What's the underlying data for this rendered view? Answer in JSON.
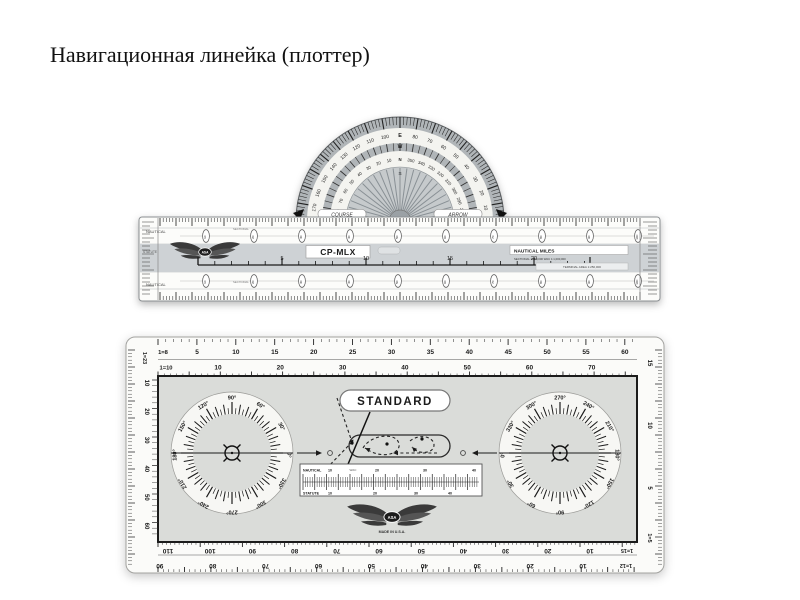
{
  "slide": {
    "title": "Навигационная линейка (плоттер)"
  },
  "cp_mlx": {
    "model": "CP-MLX",
    "brand": "ASA",
    "course_label": "COURSE",
    "arrow_label": "ARROW",
    "apex_letters": {
      "outer": "E",
      "band": "W",
      "inner": "N",
      "fan": "S"
    },
    "protractor_outer_ring": [
      "10",
      "20",
      "30",
      "40",
      "50",
      "60",
      "70",
      "80",
      "E",
      "100",
      "110",
      "120",
      "130",
      "140",
      "150",
      "160",
      "170"
    ],
    "protractor_inner_ring": [
      "280",
      "290",
      "300",
      "310",
      "320",
      "330",
      "340",
      "350",
      "N",
      "10",
      "20",
      "30",
      "40",
      "50",
      "60",
      "70",
      "80"
    ],
    "statute_label": "STATUTE",
    "nautical_label": "NAUTICAL",
    "sectional_label": "SECTIONAL",
    "mid_scale_numbers": [
      5,
      10,
      15,
      20
    ],
    "nautical_miles_label": "NAUTICAL MILES",
    "nm_sub_label": "SECTIONAL 1:500,000   WAC 1:1,000,000",
    "terminal_label": "TERMINAL AREA 1:250,000",
    "oval_numbers": [
      "10",
      "20",
      "30",
      "40",
      "50",
      "60",
      "70",
      "80",
      "90",
      "100"
    ]
  },
  "standard": {
    "title": "STANDARD",
    "brand": "ASA",
    "made_in": "MADE IN U.S.A.",
    "scales": {
      "top1": {
        "label": "1=8",
        "numbers": [
          5,
          10,
          15,
          20,
          25,
          30,
          35,
          40,
          45,
          50,
          55,
          60
        ]
      },
      "top2": {
        "label": "1=10",
        "numbers": [
          10,
          20,
          30,
          40,
          50,
          60,
          70
        ]
      },
      "left": {
        "label": "1=23",
        "numbers": [
          10,
          20,
          30,
          40,
          50,
          60
        ]
      },
      "right": {
        "label": "1=5",
        "numbers": [
          15,
          10,
          5
        ]
      },
      "bottom_inner": {
        "label": "1=15",
        "numbers": [
          10,
          20,
          30,
          40,
          50,
          60,
          70,
          80,
          90,
          100,
          110
        ]
      },
      "bottom_outer": {
        "label": "1=12",
        "numbers": [
          10,
          20,
          30,
          40,
          50,
          60,
          70,
          80,
          90
        ]
      }
    },
    "center_scale": {
      "top_label": "NAUTICAL",
      "wac_label": "WAC",
      "top_numbers": [
        10,
        20,
        30,
        40
      ],
      "bottom_label": "STATUTE",
      "bottom_numbers": [
        10,
        20,
        30,
        40
      ]
    },
    "rose_degrees": [
      0,
      30,
      60,
      90,
      120,
      150,
      180,
      210,
      240,
      270,
      300,
      330
    ],
    "rose_right_offset": 180
  },
  "colors": {
    "rim_gray": "#b0b5b8",
    "ring_white": "#f4f4f0",
    "fan_gray": "#c6cacc",
    "band_gray": "#ced2d5",
    "panel_gray": "#dadcd9",
    "disc_white": "#f7f7f4",
    "ink": "#1b1b1b"
  }
}
